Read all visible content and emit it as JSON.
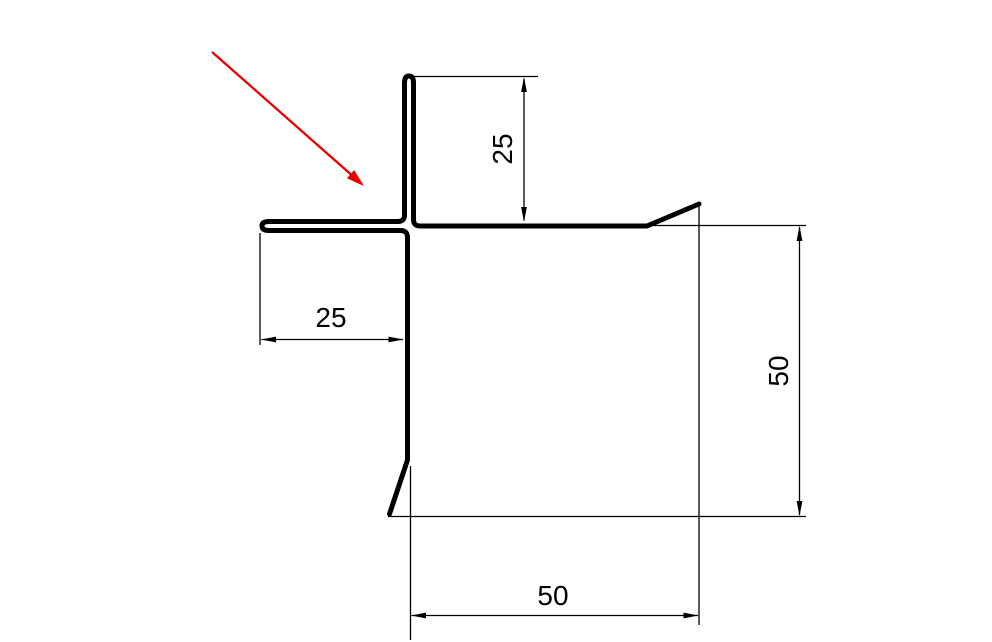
{
  "drawing": {
    "title": "corner-profile-cross-section",
    "colors": {
      "line": "#000000",
      "pointer": "#e60000",
      "background": "#ffffff"
    },
    "icons": {
      "pointer": "red-diagonal-arrow-icon"
    },
    "labels": {
      "top_leg_height": "25",
      "left_flange_width": "25",
      "right_side_height": "50",
      "bottom_side_width": "50"
    }
  }
}
